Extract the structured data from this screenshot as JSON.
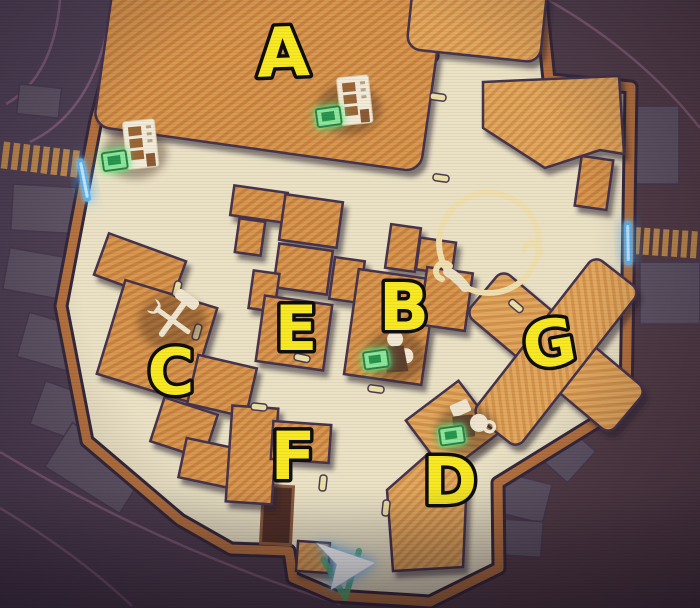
{
  "map": {
    "kind": "game-town-minimap",
    "markers": [
      {
        "label": "A",
        "poi": "vending-machine"
      },
      {
        "label": "B",
        "poi": "merchant"
      },
      {
        "label": "C",
        "poi": "crafting-tools"
      },
      {
        "label": "D",
        "poi": "coffee-stand"
      },
      {
        "label": "E",
        "poi": ""
      },
      {
        "label": "F",
        "poi": ""
      },
      {
        "label": "G",
        "poi": ""
      }
    ],
    "extra_icons": [
      "vending-machine-west-gate"
    ],
    "player": {
      "indicator": "arrow",
      "heading": "east"
    },
    "exits": [
      {
        "side": "west"
      },
      {
        "side": "east"
      }
    ],
    "colors": {
      "background": "#4d3f53",
      "plaza_floor": "#ebe2c5",
      "wall": "#b5713e",
      "building_fill": "#d89850",
      "marker_fill": "#f8e922",
      "marker_outline": "#0c0c0c",
      "highlight_green": "#8ce69a",
      "exit_blue": "#5ab5f0",
      "ring_gold": "#f0dfae",
      "player_arrow": "#fbfeff",
      "player_glow": "#3fa4f4",
      "chevron_green": "#57b06a"
    }
  }
}
